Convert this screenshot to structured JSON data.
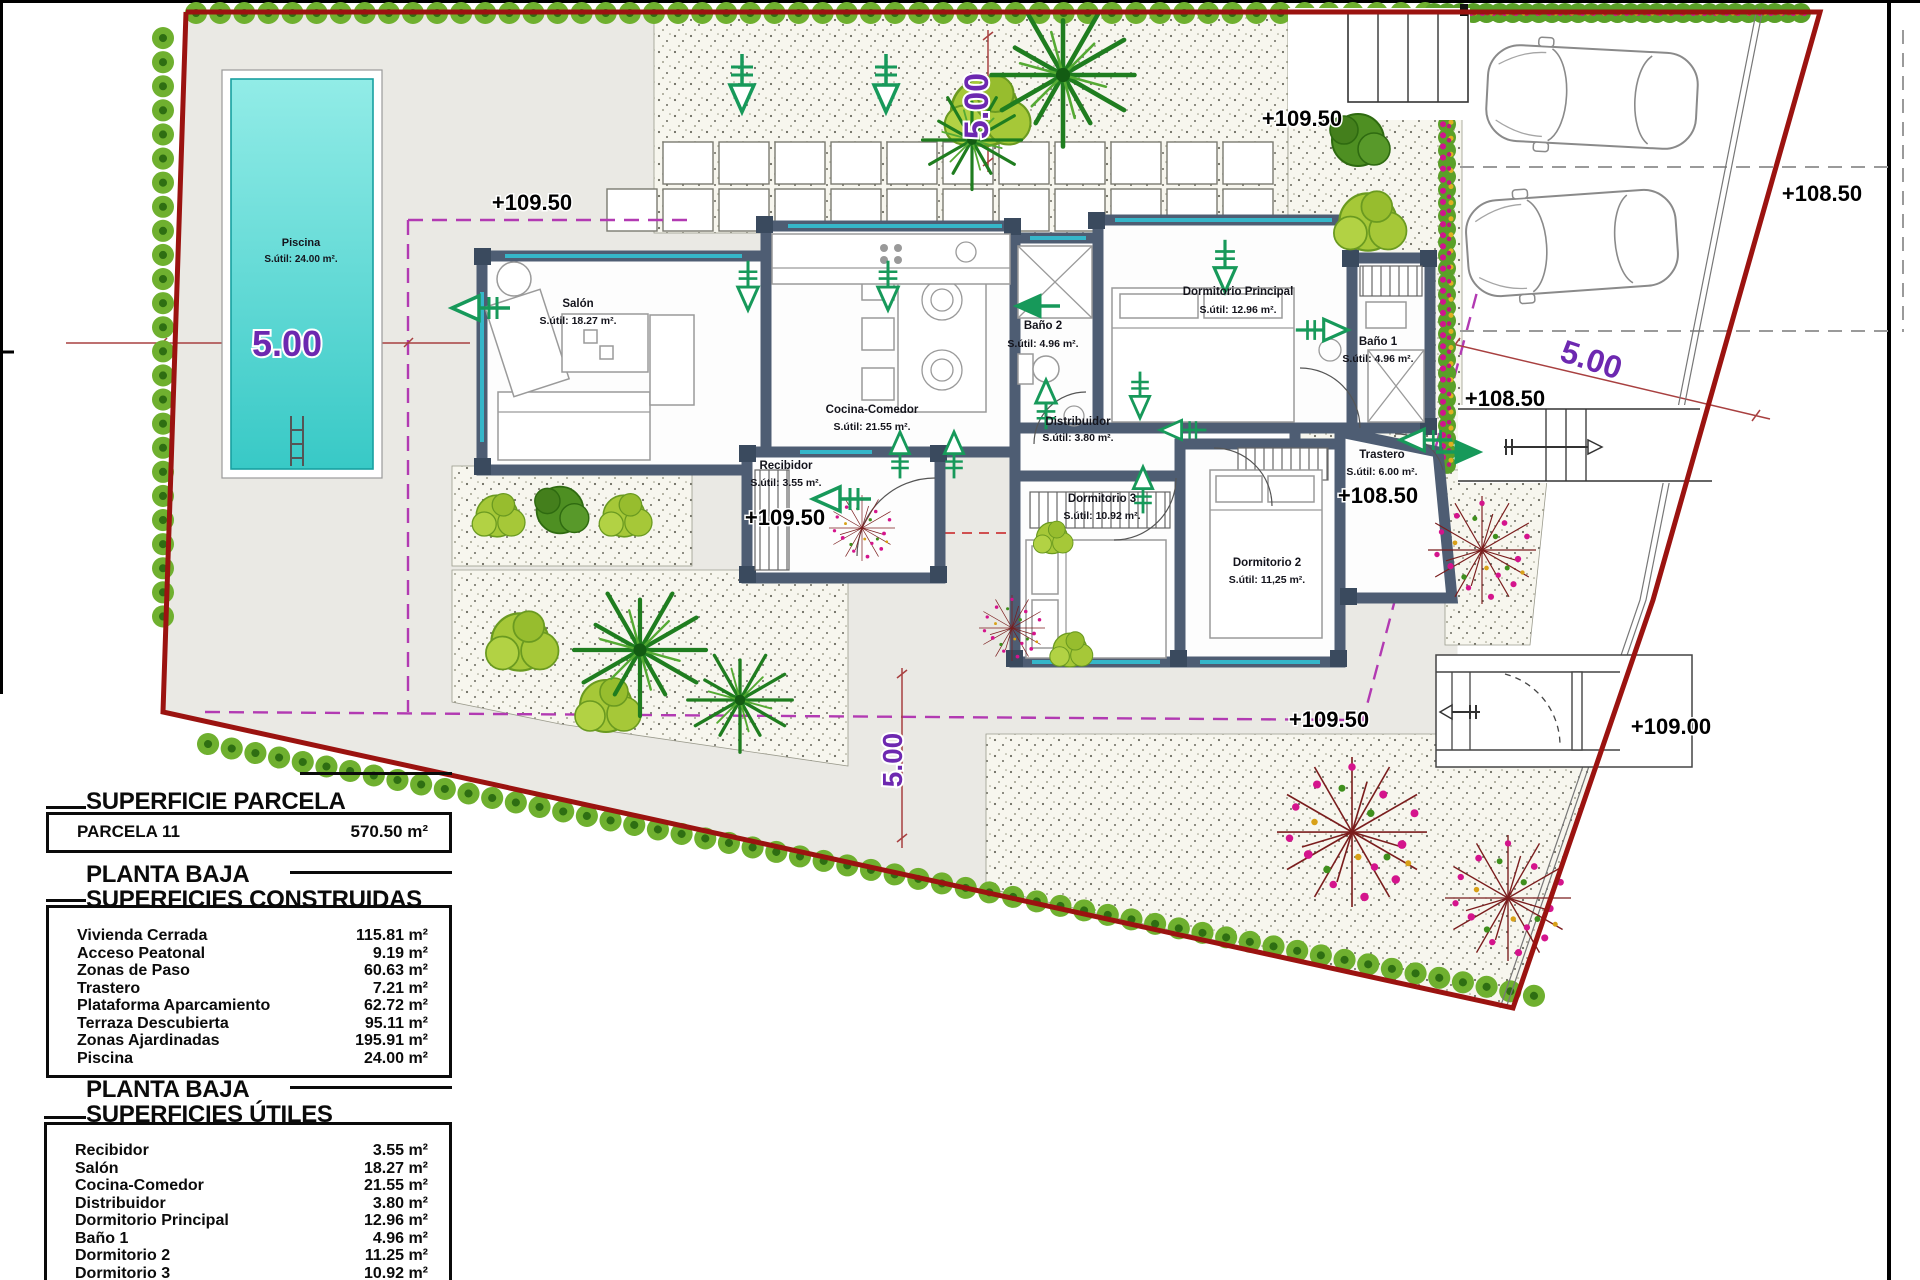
{
  "plan": {
    "pool": {
      "name": "Piscina",
      "area": "S.útil: 24.00 m²."
    },
    "rooms": {
      "salon": {
        "name": "Salón",
        "area": "S.útil: 18.27 m²."
      },
      "cocina": {
        "name": "Cocina-Comedor",
        "area": "S.útil: 21.55 m²."
      },
      "recibidor": {
        "name": "Recibidor",
        "area": "S.útil: 3.55 m²."
      },
      "banyo2": {
        "name": "Baño 2",
        "area": "S.útil: 4.96 m²."
      },
      "dormp": {
        "name": "Dormitorio Principal",
        "area": "S.útil: 12.96 m²."
      },
      "banyo1": {
        "name": "Baño 1",
        "area": "S.útil: 4.96 m²."
      },
      "distribuidor": {
        "name": "Distribuidor",
        "area": "S.útil: 3.80 m²."
      },
      "dorm3": {
        "name": "Dormitorio 3",
        "area": "S.útil: 10.92 m²."
      },
      "dorm2": {
        "name": "Dormitorio 2",
        "area": "S.útil: 11,25 m²."
      },
      "trastero": {
        "name": "Trastero",
        "area": "S.útil: 6.00 m²."
      }
    },
    "levels": {
      "terrace": "+109.50",
      "parking": "+109.50",
      "entry": "+109.50",
      "path": "+109.50",
      "right_top": "+108.50",
      "right_mid": "+108.50",
      "trastero": "+108.50",
      "bottom_right": "+109.00"
    },
    "dims": {
      "pool": "5.00",
      "top": "5.00",
      "right": "5.00",
      "bottom": "5.00"
    },
    "colors": {
      "boundary": "#9b1310",
      "walls": "#4e5d73",
      "pool": "#3cc9c6",
      "hedge": "#6fb02f",
      "arrow": "#17995a",
      "dimension": "#6d28b0",
      "flowers": "#d0148e"
    }
  },
  "tables": {
    "parcela": {
      "title": "SUPERFICIE PARCELA",
      "rows": [
        {
          "label": "PARCELA 11",
          "value": "570.50 m²"
        }
      ]
    },
    "construidas": {
      "title1": "PLANTA BAJA",
      "title2": "SUPERFICIES CONSTRUIDAS",
      "rows": [
        {
          "label": "Vivienda Cerrada",
          "value": "115.81 m²"
        },
        {
          "label": "Acceso Peatonal",
          "value": "9.19 m²"
        },
        {
          "label": "Zonas de Paso",
          "value": "60.63 m²"
        },
        {
          "label": "Trastero",
          "value": "7.21 m²"
        },
        {
          "label": "Plataforma Aparcamiento",
          "value": "62.72 m²"
        },
        {
          "label": "Terraza Descubierta",
          "value": "95.11 m²"
        },
        {
          "label": "Zonas Ajardinadas",
          "value": "195.91 m²"
        },
        {
          "label": "Piscina",
          "value": "24.00 m²"
        }
      ]
    },
    "utiles": {
      "title1": "PLANTA BAJA",
      "title2": "SUPERFICIES ÚTILES",
      "rows": [
        {
          "label": "Recibidor",
          "value": "3.55 m²"
        },
        {
          "label": "Salón",
          "value": "18.27 m²"
        },
        {
          "label": "Cocina-Comedor",
          "value": "21.55 m²"
        },
        {
          "label": "Distribuidor",
          "value": "3.80 m²"
        },
        {
          "label": "Dormitorio Principal",
          "value": "12.96 m²"
        },
        {
          "label": "Baño 1",
          "value": "4.96 m²"
        },
        {
          "label": "Dormitorio 2",
          "value": "11.25 m²"
        },
        {
          "label": "Dormitorio 3",
          "value": "10.92 m²"
        },
        {
          "label": "Baño 2",
          "value": "4.96 m²"
        }
      ]
    }
  }
}
